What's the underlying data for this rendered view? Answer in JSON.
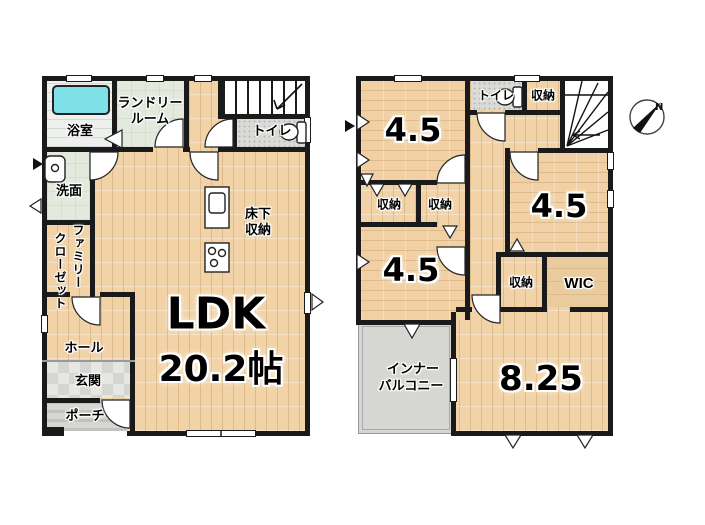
{
  "floor1": {
    "bath_label": "浴室",
    "laundry_label_line1": "ランドリー",
    "laundry_label_line2": "ルーム",
    "toilet_label": "トイレ",
    "washroom_label": "洗面",
    "family_closet_line1": "ファミリー",
    "family_closet_line2": "クローゼット",
    "underfloor_storage_line1": "床下",
    "underfloor_storage_line2": "収納",
    "hall_label": "ホール",
    "entrance_label": "玄関",
    "porch_label": "ポーチ",
    "ldk_label": "LDK",
    "ldk_area": "20.2帖"
  },
  "floor2": {
    "toilet_label": "トイレ",
    "storage_top_label": "収納",
    "room_top_left_area": "4.5",
    "storage_mid_left_label": "収納",
    "storage_mid_right_label": "収納",
    "room_bottom_left_area": "4.5",
    "room_right_area": "4.5",
    "storage_small_label": "収納",
    "wic_label": "WIC",
    "balcony_line1": "インナー",
    "balcony_line2": "バルコニー",
    "room_main_area": "8.25"
  },
  "compass": {
    "north_label": "N"
  },
  "colors": {
    "wall": "#1a1a1a",
    "wood_floor": "#f2d3a7",
    "bathtub": "#7fe0e8",
    "green_floor": "#e3eadd",
    "tile_gray": "#dadad7",
    "balcony_floor": "#d6d6d2"
  }
}
